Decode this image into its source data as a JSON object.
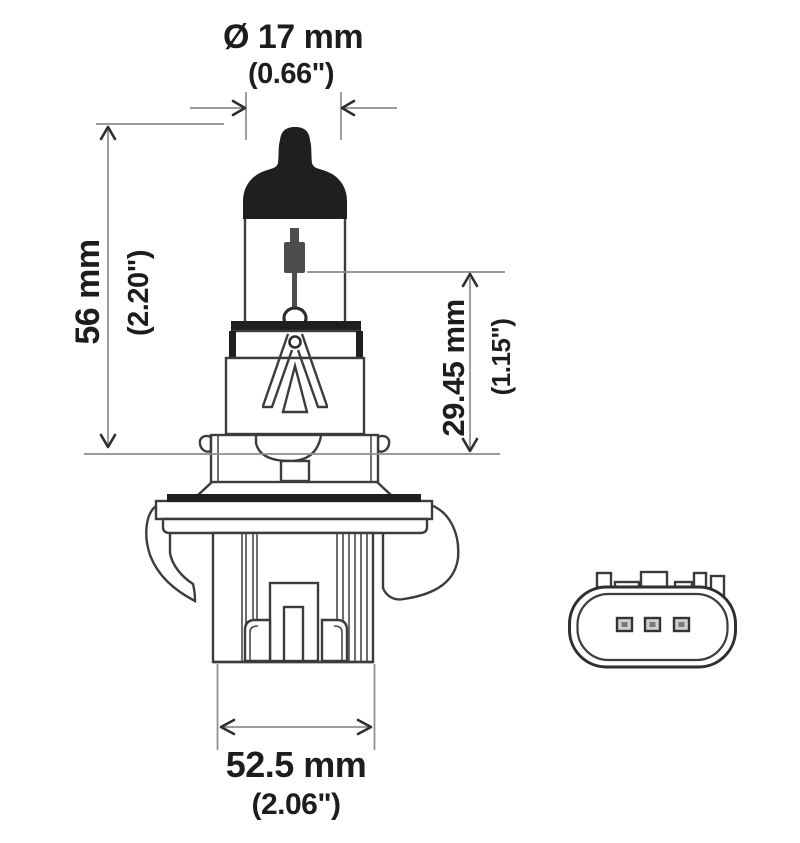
{
  "drawing": {
    "description": "halogen bulb technical dimension drawing with plug connector face view",
    "dimensions": {
      "diameter_mm": "Ø 17 mm",
      "diameter_in": "(0.66\")",
      "length_mm": "56 mm",
      "length_in": "(2.20\")",
      "filament_mm": "29.45 mm",
      "filament_in": "(1.15\")",
      "width_mm": "52.5 mm",
      "width_in": "(2.06\")"
    },
    "colors": {
      "background": "#ffffff",
      "outline": "#3c3c3c",
      "dark_fill": "#1f1f1f",
      "dimension_line": "#8d8d8d",
      "arrowhead": "#2e2e2e",
      "text": "#1d1d1d"
    },
    "parts": {
      "bulb": [
        "black-tip",
        "glass-envelope",
        "filament",
        "base-housing",
        "support-frame",
        "collar",
        "mounting-flange",
        "spring-clips",
        "plug-body"
      ],
      "connector": [
        "socket-face",
        "three-pins",
        "keying-tabs"
      ]
    }
  }
}
